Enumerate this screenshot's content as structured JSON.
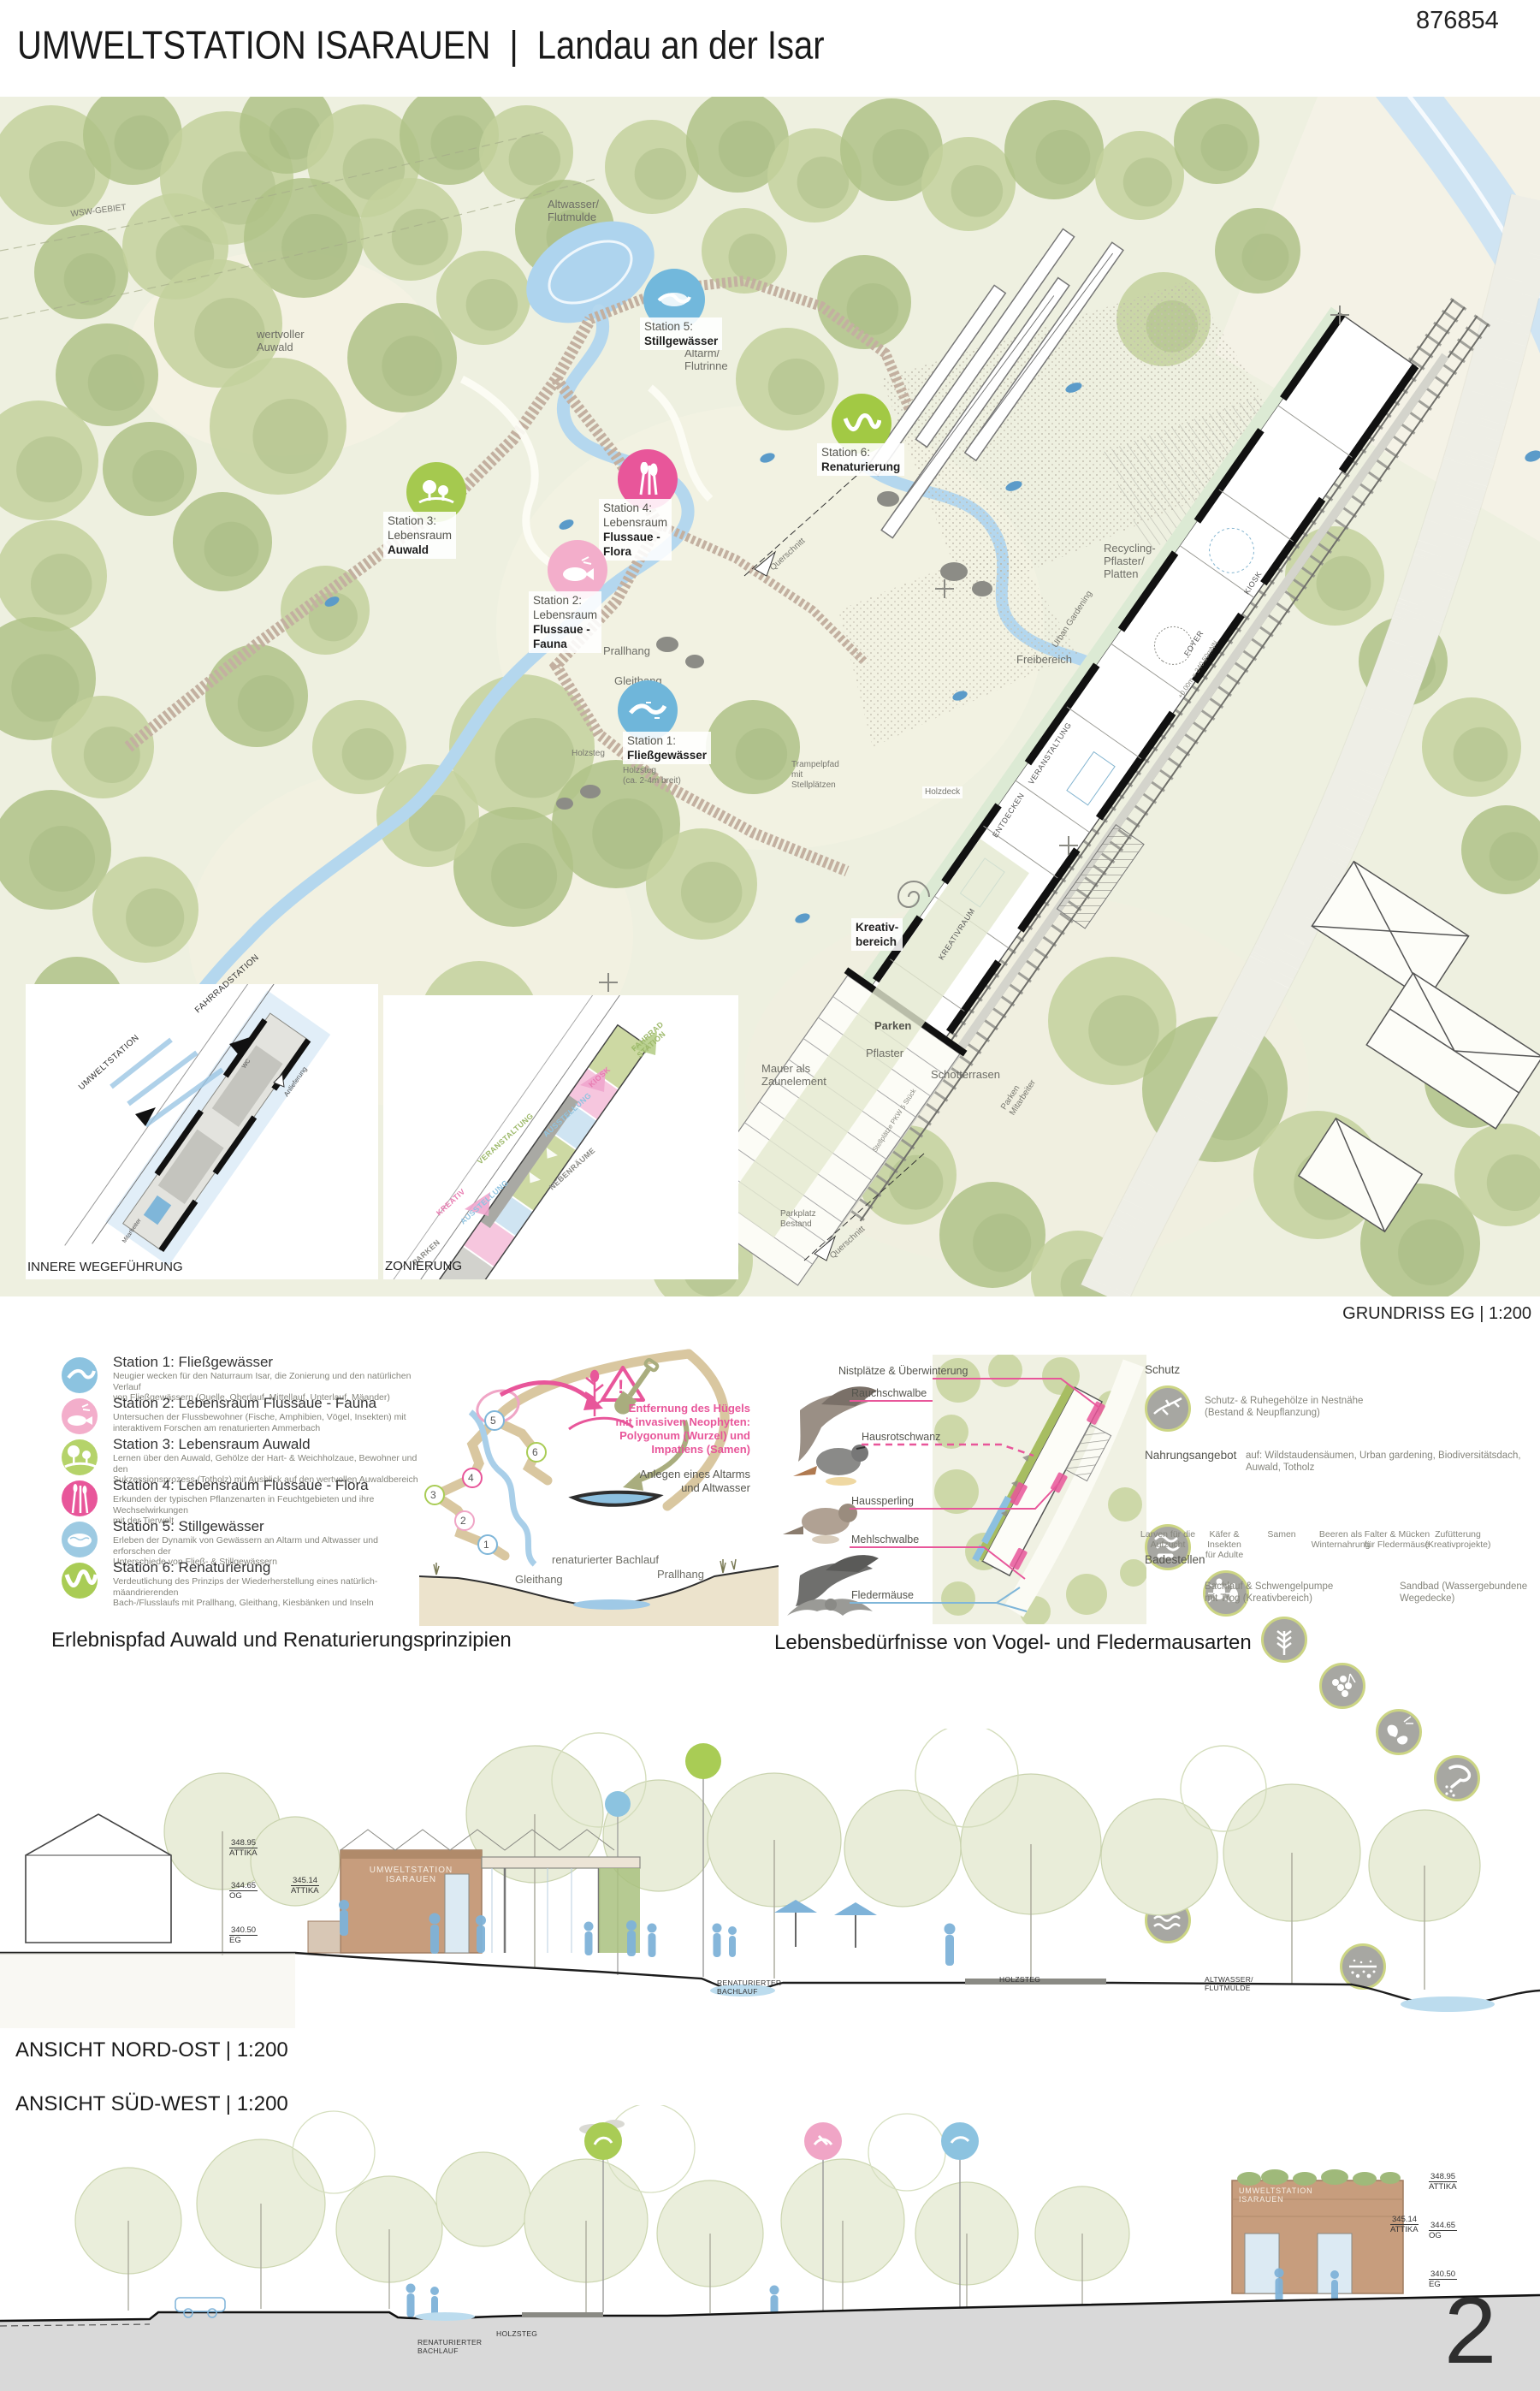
{
  "header": {
    "title_main": "UMWELTSTATION ISARAUEN",
    "sep": "|",
    "title_sub": "Landau an der Isar",
    "code": "876854"
  },
  "plan": {
    "caption": "GRUNDRISS EG | 1:200",
    "labels": {
      "altwasser": "Altwasser/\nFlutmulde",
      "wertvoller": "wertvoller\nAuwald",
      "altarm": "Altarm/\nFlutrinne",
      "wsg": "WSW-GEBIET",
      "prallhang": "Prallhang",
      "gleithang": "Gleithang",
      "holzsteg": "Holzsteg",
      "holzsteg2": "Holzsteg\n(ca. 2-4m breit)",
      "trampelpfad": "Trampelpfad\nmit\nStellplätzen",
      "recycling": "Recycling-\nPflaster/\nPlatten",
      "freibereich": "Freibereich",
      "urban": "Urban Gardening",
      "holzdeck": "Holzdeck",
      "kreativ": "Kreativ-\nbereich",
      "parken": "Parken",
      "pflaster": "Pflaster",
      "mauer": "Mauer als\nZaunelement",
      "schotter": "Schotterrasen",
      "parken_ma": "Parken\nMitarbeiter",
      "parkplatz": "Parkplatz\nBestand",
      "querschnitt": "Querschnitt",
      "stellplaetze": "Stellplätze PKW 5 Stück",
      "hoehe": "+0.00m = 340.50mNN",
      "room_veranstaltung": "VERANSTALTUNG",
      "room_entdecken": "ENTDECKEN",
      "room_foyer": "FOYER",
      "room_kiosk": "KIOSK",
      "room_kreativraum": "KREATIVRAUM"
    },
    "stations": [
      {
        "pre": "Station 1:",
        "name": "Fließgewässer",
        "color": "#6fb6da"
      },
      {
        "pre": "Station 2:\nLebensraum",
        "name": "Flussaue -\nFauna",
        "color": "#f3aecb"
      },
      {
        "pre": "Station 3:\nLebensraum",
        "name": "Auwald",
        "color": "#a5c94f"
      },
      {
        "pre": "Station 4:\nLebensraum",
        "name": "Flussaue -\nFlora",
        "color": "#e8569a"
      },
      {
        "pre": "Station 5:",
        "name": "Stillgewässer",
        "color": "#72b8dc"
      },
      {
        "pre": "Station 6:",
        "name": "Renaturierung",
        "color": "#a2c944"
      }
    ]
  },
  "insets": {
    "inner": {
      "caption": "INNERE WEGEFÜHRUNG",
      "fahrrad": "FAHRRADSTATION",
      "umwelt": "UMWELTSTATION",
      "anlieferung": "Anlieferung",
      "wc": "WC",
      "mitarbeiter": "Mitarbeiter"
    },
    "zoning": {
      "caption": "ZONIERUNG",
      "zones": [
        {
          "label": "FAHRRAD\nSTATION",
          "color": "#9db96a"
        },
        {
          "label": "KIOSK",
          "color": "#e87bb1"
        },
        {
          "label": "AUSSTELLUNG",
          "color": "#8fc3e0"
        },
        {
          "label": "VERANSTALTUNG",
          "color": "#9db96a"
        },
        {
          "label": "NEBENRÄUME",
          "color": "#8a8a86"
        },
        {
          "label": "AUSSTELLUNG",
          "color": "#8fc3e0"
        },
        {
          "label": "KREATIV",
          "color": "#e87bb1"
        },
        {
          "label": "PARKEN",
          "color": "#8a8a86"
        }
      ]
    }
  },
  "legend": {
    "caption": "Erlebnispfad Auwald und Renaturierungsprinzipien",
    "stations": [
      {
        "title": "Station 1: Fließgewässer",
        "desc": "Neugier wecken für den Naturraum Isar, die Zonierung und den natürlichen Verlauf\nvon Fließgewässern (Quelle, Oberlauf, Mittellauf, Unterlauf, Mäander)",
        "color": "#8cc3e0"
      },
      {
        "title": "Station 2: Lebensraum Flussaue - Fauna",
        "desc": "Untersuchen der Flussbewohner (Fische, Amphibien, Vögel, Insekten) mit\ninteraktivem Forschen am renaturierten Ammerbach",
        "color": "#f3aecb"
      },
      {
        "title": "Station 3: Lebensraum Auwald",
        "desc": "Lernen über den Auwald, Gehölze der Hart- & Weichholzaue, Bewohner und den\nSukzessionsprozess (Totholz) mit Ausblick auf den wertvollen Auwaldbereich",
        "color": "#b5d36a"
      },
      {
        "title": "Station 4: Lebensraum Flussaue - Flora",
        "desc": "Erkunden der typischen Pflanzenarten in Feuchtgebieten und ihre Wechselwirkungen\nmit der Tierwelt",
        "color": "#e8569a"
      },
      {
        "title": "Station 5: Stillgewässer",
        "desc": "Erleben der Dynamik von Gewässern an Altarm und Altwasser und erforschen der\nUnterschiede von Fließ- & Stillgewässern",
        "color": "#9dcae2"
      },
      {
        "title": "Station 6: Renaturierung",
        "desc": "Verdeutlichung des Prinzips der Wiederherstellung eines natürlich-mäandrierenden\nBach-/Flusslaufs mit Prallhang, Gleithang, Kiesbänken und Inseln",
        "color": "#a9cc55"
      }
    ]
  },
  "renat": {
    "numbers": [
      "1",
      "2",
      "3",
      "4",
      "5",
      "6"
    ],
    "warn": "Entfernung des Hügels\nmit invasiven Neophyten:\nPolygonum (Wurzel) und\nImpatiens (Samen)",
    "altarm": "Anlegen eines Altarms\nund Altwasser",
    "bachlauf": "renaturierter Bachlauf",
    "gleithang": "Gleithang",
    "prallhang": "Prallhang",
    "warn_mark": "!"
  },
  "birds": {
    "caption": "Lebensbedürfnisse von Vogel- und Fledermausarten",
    "header": "Nistplätze & Überwinterung",
    "species": [
      "Rauchschwalbe",
      "Hausrotschwanz",
      "Haussperling",
      "Mehlschwalbe",
      "Fledermäuse"
    ]
  },
  "habitat": {
    "schutz_h": "Schutz",
    "schutz_t": "Schutz- & Ruhegehölze in Nestnähe\n(Bestand & Neupflanzung)",
    "nahrung_h": "Nahrungsangebot",
    "nahrung_t": "auf: Wildstaudensäumen, Urban gardening, Biodiversitätsdach, Auwald, Totholz",
    "items": [
      "Larven für die\nAufzucht",
      "Käfer & Insekten\nfür Adulte",
      "Samen",
      "Beeren als\nWinternahrung",
      "Falter & Mücken\nfür Fledermäuse",
      "Zufütterung\n(Kreativprojekte)"
    ],
    "bade_h": "Badestellen",
    "bade1": "Bachlauf & Schwengelpumpe\nmit Trog (Kreativbereich)",
    "bade2": "Sandbad (Wassergebundene\nWegedecke)"
  },
  "sections": {
    "ne_caption": "ANSICHT NORD-OST | 1:200",
    "sw_caption": "ANSICHT SÜD-WEST | 1:200",
    "sign": "UMWELTSTATION\nISARAUEN",
    "m1v": "348.95",
    "m1l": "ATTIKA",
    "m2v": "345.14",
    "m2l": "ATTIKA",
    "m3v": "344.65",
    "m3l": "OG",
    "m4v": "340.50",
    "m4l": "EG",
    "gl1": "RENATURIERTER\nBACHLAUF",
    "gl2": "HOLZSTEG",
    "gl3": "ALTWASSER/\nFLUTMULDE"
  },
  "page": {
    "number": "2"
  }
}
